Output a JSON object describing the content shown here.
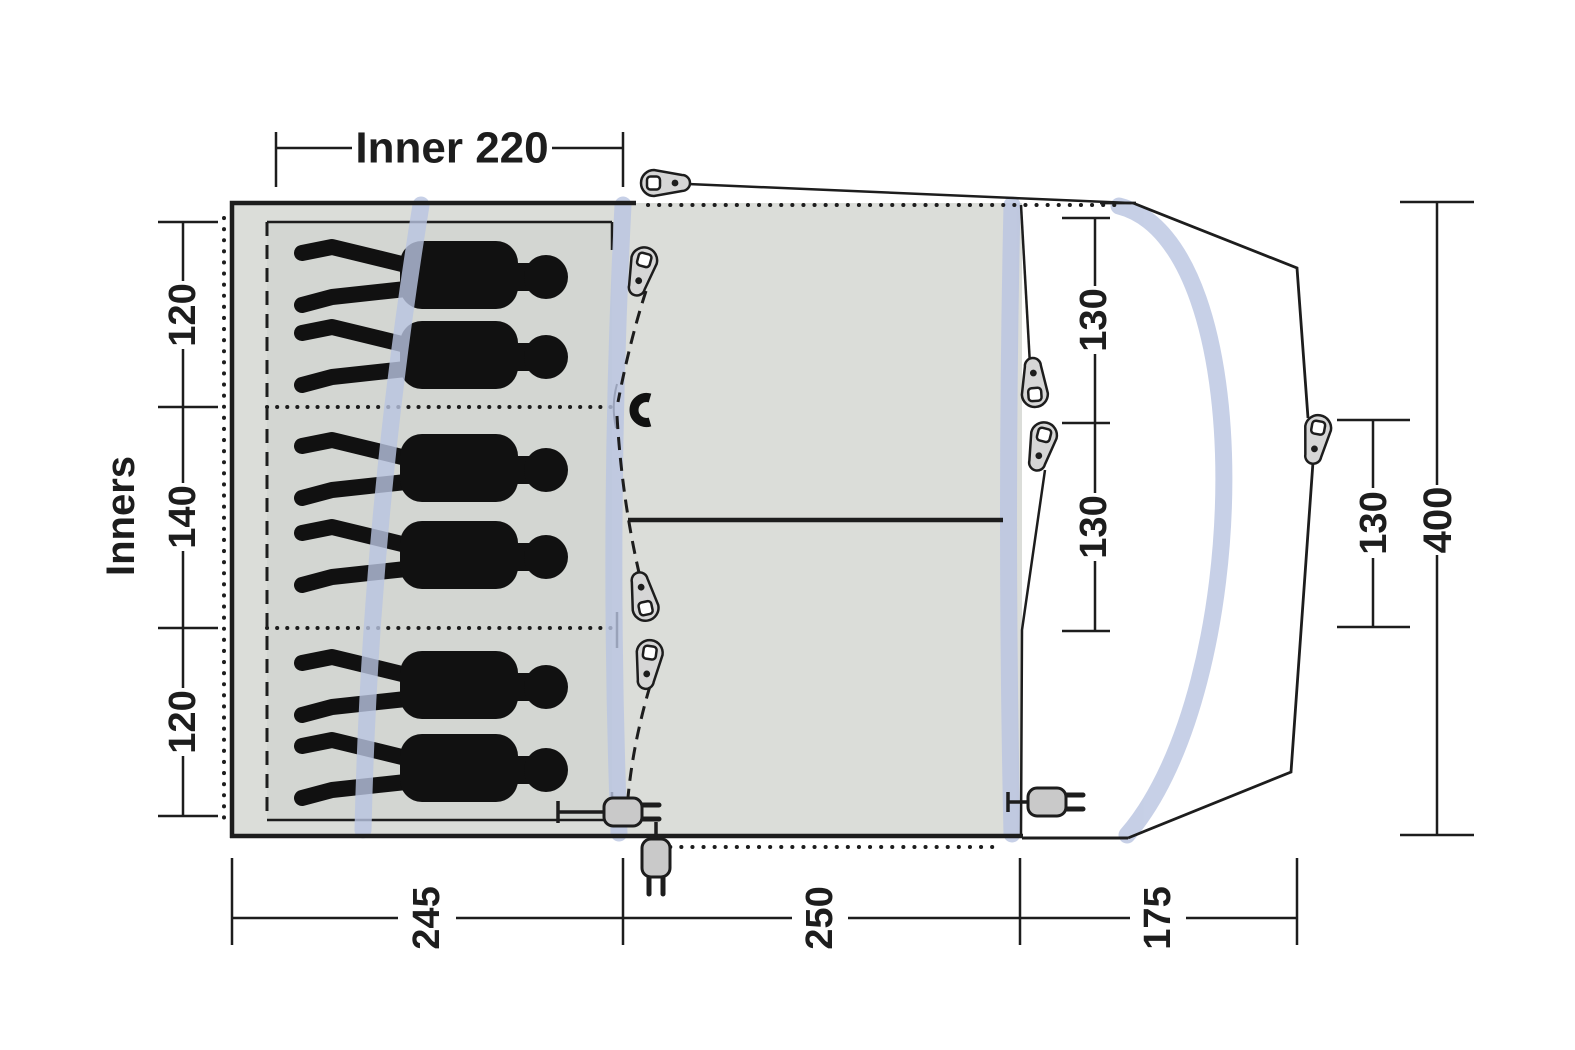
{
  "diagram": {
    "type": "tent-floorplan-top-view",
    "labels": {
      "inner_width": "Inner 220",
      "inners": "Inners",
      "left_top": "120",
      "left_middle": "140",
      "left_bottom": "120",
      "right_front_top": "130",
      "right_front_bottom": "130",
      "right_canopy": "130",
      "total_width": "400",
      "bottom_inner": "245",
      "bottom_living": "250",
      "bottom_canopy": "175"
    },
    "sections": {
      "sleeping_compartments": 3,
      "figures_per_compartment": [
        2,
        2,
        2
      ],
      "total_figures": 6
    },
    "icons": [
      "tent-peg-icon",
      "magnet-clip-icon",
      "power-plug-icon",
      "pole-arc",
      "person-silhouette"
    ],
    "colors": {
      "background": "#ffffff",
      "tent_fill": "#dbddd9",
      "inner_fill": "#d3d6d2",
      "pole_blue": "#b9c4e1",
      "line": "#1d1d1d",
      "figure": "#111111",
      "peg_fill": "#d6d6d6",
      "plug_fill": "#c9c9c9"
    }
  }
}
